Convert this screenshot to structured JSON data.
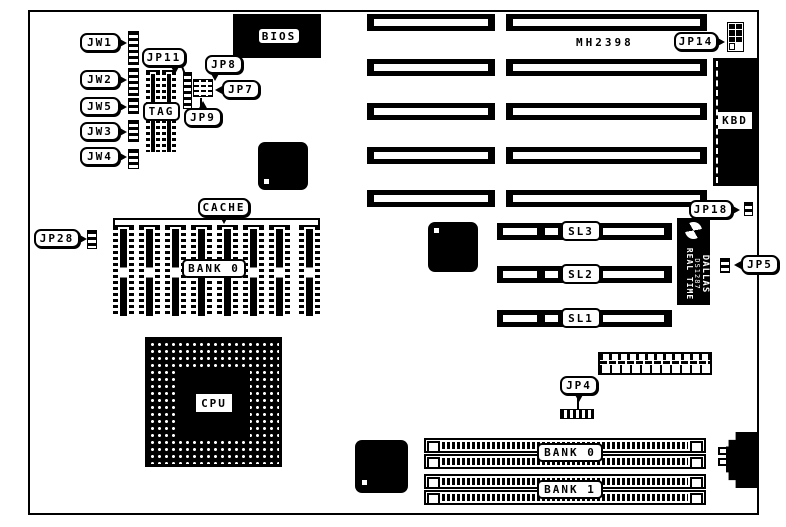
{
  "board": {
    "model": "MH2398"
  },
  "callouts": {
    "jw1": "JW1",
    "jw2": "JW2",
    "jw5": "JW5",
    "jw3": "JW3",
    "jw4": "JW4",
    "jp11": "JP11",
    "jp8": "JP8",
    "jp7": "JP7",
    "jp9": "JP9",
    "jp28": "JP28",
    "jp14": "JP14",
    "jp18": "JP18",
    "jp5": "JP5",
    "jp4": "JP4",
    "cache": "CACHE"
  },
  "components": {
    "bios": "BIOS",
    "tag": "TAG",
    "cpu": "CPU",
    "kbd": "KBD",
    "cache_bank": "BANK 0",
    "sl3": "SL3",
    "sl2": "SL2",
    "sl1": "SL1",
    "simm_bank0": "BANK 0",
    "simm_bank1": "BANK 1",
    "dallas_brand": "DALLAS",
    "dallas_part": "DS1287",
    "dallas_type": "REAL TIME"
  },
  "colors": {
    "ink": "#000000",
    "paper": "#ffffff"
  }
}
